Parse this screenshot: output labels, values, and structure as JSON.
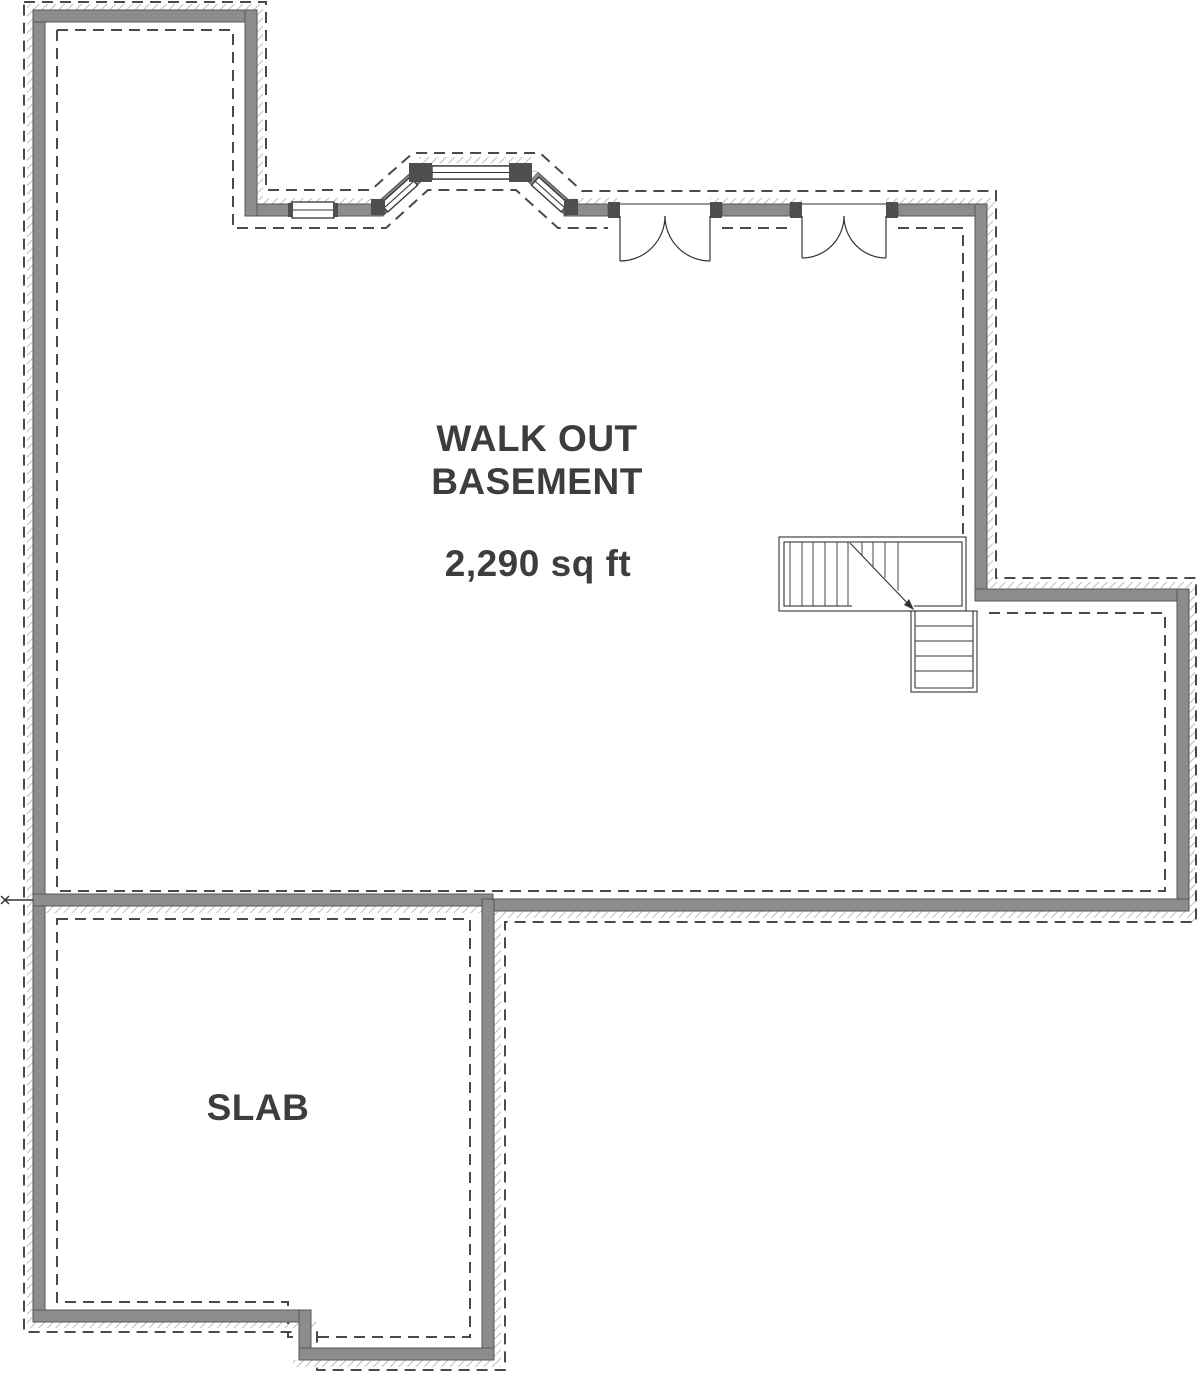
{
  "floor_plan": {
    "basement": {
      "label_line1": "WALK OUT",
      "label_line2": "BASEMENT",
      "area": "2,290 sq ft"
    },
    "slab": {
      "label": "SLAB"
    },
    "colors": {
      "wall_fill": "#8c8c8c",
      "wall_edge": "#575757",
      "dark_fixture": "#4e4e4e",
      "dashed_line": "#4a4a4a",
      "detail_line": "#333333",
      "label_text": "#3d3d3d",
      "hatch": "#bdbdbd"
    }
  }
}
